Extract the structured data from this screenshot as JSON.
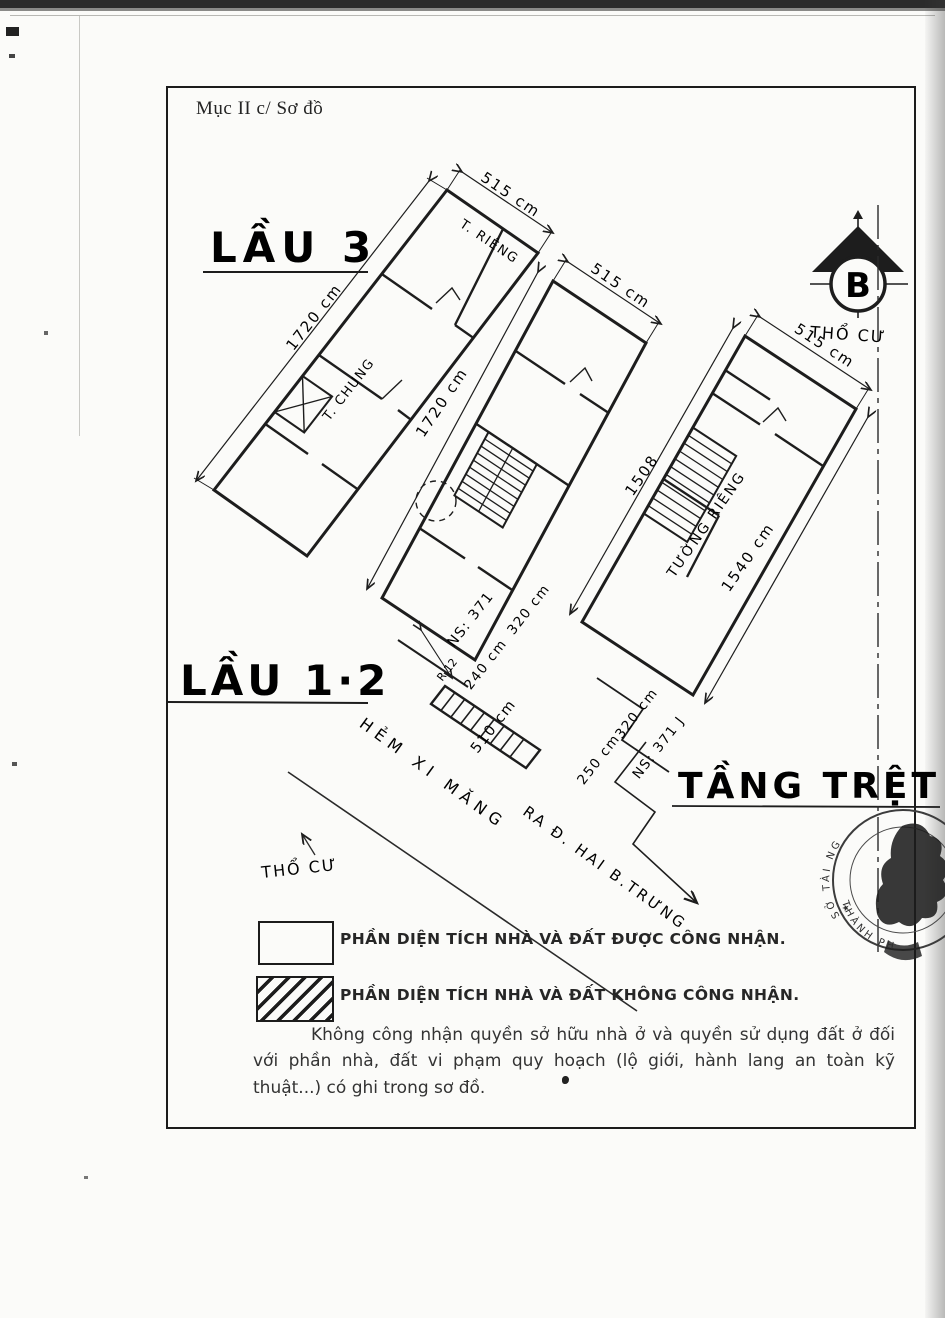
{
  "page": {
    "section_label": "Mục II c/ Sơ đồ",
    "note": "Không công nhận quyền sở hữu nhà ở và quyền sử dụng đất ở đối với phần nhà, đất vi phạm quy hoạch (lộ giới, hành lang an toàn kỹ thuật...) có ghi trong sơ đồ."
  },
  "compass": {
    "letter": "B",
    "label": "THỔ CƯ"
  },
  "floors": {
    "lau3": {
      "label": "LẦU 3",
      "width_dim": "515 cm",
      "length_dim": "1720 cm",
      "room_private": "T. RIÊNG",
      "room_shared": "T. CHUNG"
    },
    "lau12": {
      "label": "LẦU 1·2",
      "width_dim": "515 cm",
      "length_dim": "1720 cm",
      "ns": "NS: 371",
      "dim_240": "240 cm",
      "dim_320": "320 cm",
      "dim_510": "510 cm",
      "mark_r12": "R 12"
    },
    "tang_tret": {
      "label": "TẦNG TRỆT",
      "width_dim": "515 cm",
      "length_dim_left": "1508",
      "length_dim_right": "1540 cm",
      "wall_label": "TƯỜNG RIÊNG",
      "dim_320": "320 cm",
      "dim_250": "250 cm",
      "ns": "NS: 371 J"
    }
  },
  "site": {
    "land_label": "THỔ CƯ",
    "alley_1": "HẺM XI MĂNG",
    "alley_2": "RA Đ. HAI B.TRƯNG"
  },
  "legend": {
    "recognized": "PHẦN DIỆN TÍCH NHÀ VÀ ĐẤT ĐƯỢC CÔNG NHẬN.",
    "not_recognized": "PHẦN DIỆN TÍCH NHÀ VÀ ĐẤT KHÔNG CÔNG NHẬN."
  },
  "stamp": {
    "arc_top": "SỞ TÀI NG",
    "arc_bottom": "THÀNH PHỐ",
    "star": "★"
  },
  "colors": {
    "ink": "#1d1d1d",
    "paper": "#fbfbf9"
  }
}
